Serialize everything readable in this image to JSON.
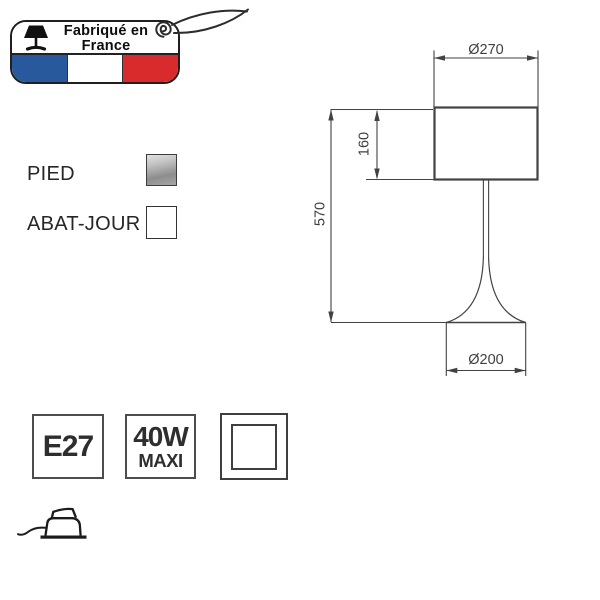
{
  "badge": {
    "title_line1": "Fabriqué en",
    "title_line2": "France",
    "flag_colors": {
      "blue": "#27599c",
      "white": "#ffffff",
      "red": "#d92b2b"
    },
    "icons": {
      "lamp": "table-lamp-silhouette",
      "eyelet": "hang-tag-eyelet-spiral",
      "string": "hang-tag-string"
    }
  },
  "materials": [
    {
      "label": "PIED",
      "swatch": "metallic-gray",
      "swatch_color": "#a6a6a6"
    },
    {
      "label": "ABAT-JOUR",
      "swatch": "white",
      "swatch_color": "#ffffff"
    }
  ],
  "drawing": {
    "shade_diameter_label": "Ø270",
    "shade_height_label": "160",
    "total_height_label": "570",
    "base_diameter_label": "Ø200",
    "line_color": "#424242"
  },
  "specs": {
    "socket_label": "E27",
    "power_line1": "40W",
    "power_line2": "MAXI",
    "insulation_icon": "class-ii-double-square",
    "care_icon": "iron-with-cord"
  }
}
